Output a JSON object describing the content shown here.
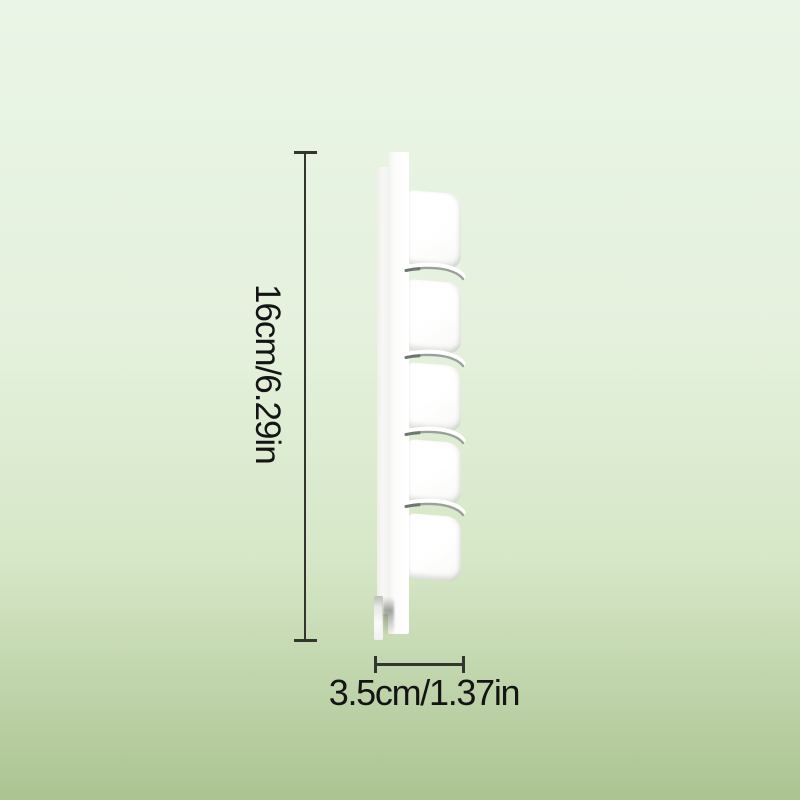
{
  "background": {
    "gradient_top": "#EAF5E7",
    "gradient_bottom": "#ABC391"
  },
  "dimension_annotations": {
    "height": {
      "label": "16cm/6.29in"
    },
    "depth": {
      "label": "3.5cm/1.37in"
    },
    "line_color": "#32362F",
    "label_color": "#141414"
  },
  "product": {
    "color": "#FFFFFF",
    "hook_count": 5
  }
}
